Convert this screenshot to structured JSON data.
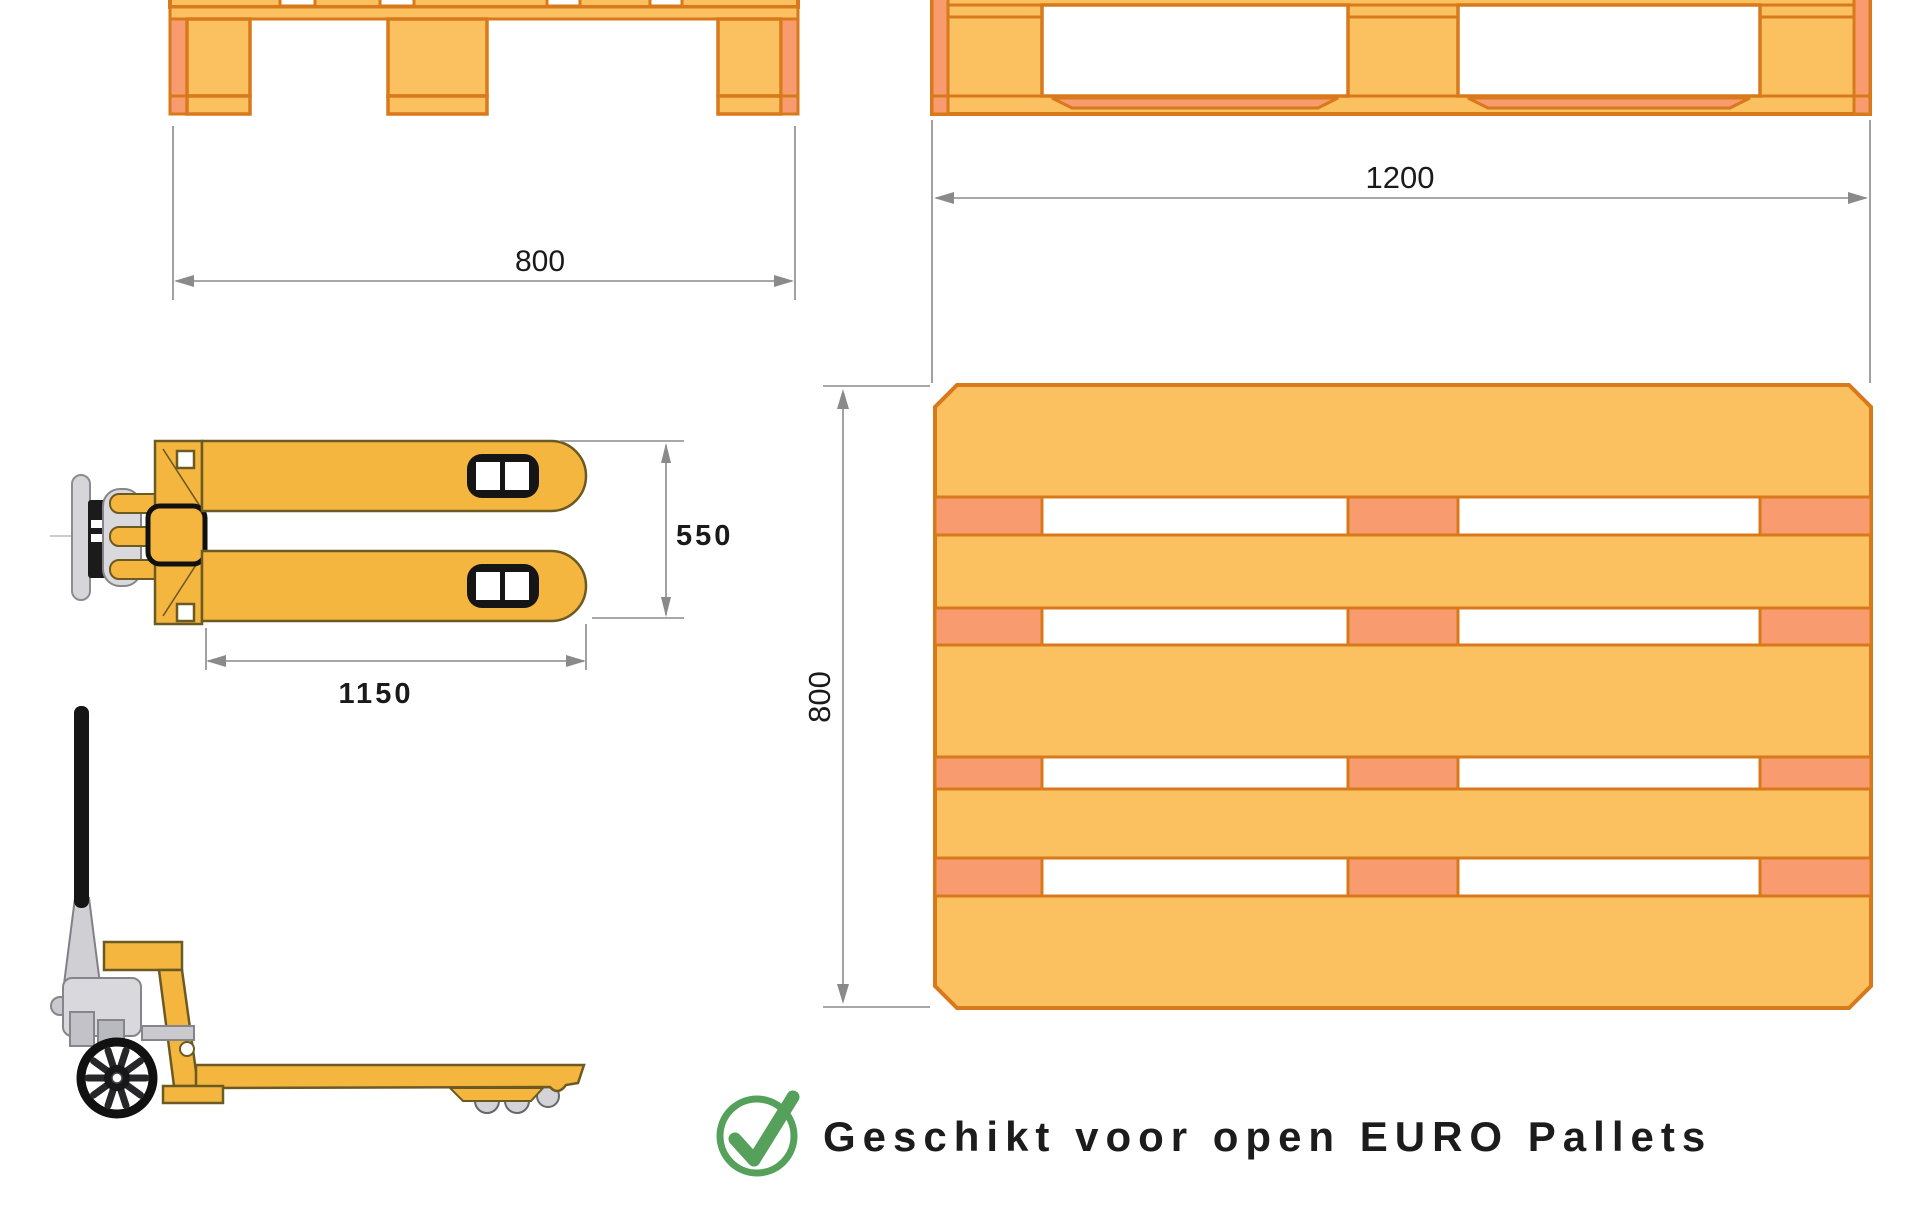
{
  "dimensions": {
    "pallet_end_width": "800",
    "pallet_side_length": "1200",
    "truck_fork_outer_width": "550",
    "truck_fork_length": "1150",
    "pallet_top_depth": "800"
  },
  "caption": {
    "icon": "checkmark-icon",
    "text": "Geschikt voor open EURO Pallets"
  },
  "colors": {
    "pallet_fill": "#FBC161",
    "pallet_outline": "#D8791B",
    "pallet_accent": "#F89B6E",
    "truck_body": "#F5B63F",
    "metal_gray": "#D6D6DA",
    "handle_black": "#151515",
    "dimension_line": "#8A8A8A",
    "check_green": "#55A05A",
    "text": "#1C1C1C"
  }
}
